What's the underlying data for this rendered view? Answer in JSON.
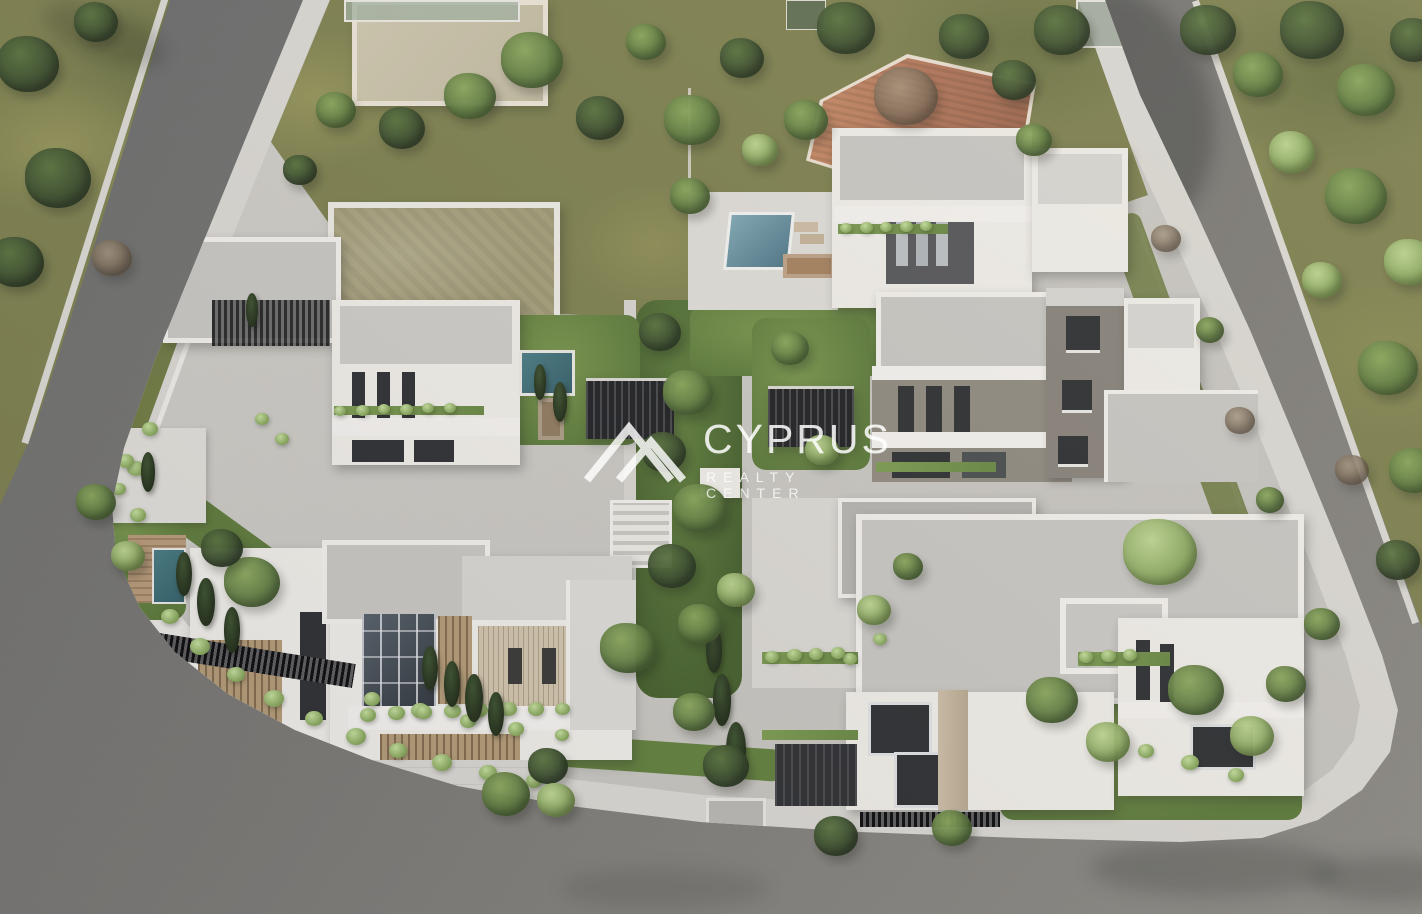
{
  "watermark": {
    "brand": "CYPRUS",
    "tagline": "REALTY CENTER",
    "logo": "mountain-peaks-icon"
  },
  "scene": {
    "setting": "Aerial 3D architectural rendering of a modern white villa development on a corner block bounded by asphalt roads, with landscaped gardens, swimming pools, pergolas and mature trees",
    "colors": {
      "asphalt": "#73726e",
      "asphalt_dark": "#585a5c",
      "sidewalk": "#dcdad5",
      "concrete": "#c9c7c2",
      "grass": "#7d8050",
      "wall_white": "#edebe6",
      "roof_gray": "#c6c5c1",
      "accent_dark": "#4e4f52",
      "taupe": "#8f8a80",
      "window": "#2f3134",
      "wood": "#a68d6e",
      "travertine": "#c3b59f",
      "terracotta_roof": "#b57a5c",
      "pool_light": "#8fc2ca",
      "pool_dark": "#41707a",
      "pergola": "#2c2d2f",
      "garden": "#66833f"
    },
    "pools": [
      {
        "id": "pool-top-villa",
        "tone": "light"
      },
      {
        "id": "pool-left-villa",
        "tone": "dark"
      },
      {
        "id": "pool-bottom-left-villa",
        "tone": "dark"
      }
    ],
    "trees": [
      {
        "x": 28,
        "y": 64,
        "s": 62,
        "t": "d"
      },
      {
        "x": 96,
        "y": 22,
        "s": 44,
        "t": "d"
      },
      {
        "x": 58,
        "y": 178,
        "s": 66,
        "t": "d"
      },
      {
        "x": 16,
        "y": 262,
        "s": 56,
        "t": "d"
      },
      {
        "x": 112,
        "y": 258,
        "s": 40,
        "t": "b"
      },
      {
        "x": 336,
        "y": 110,
        "s": 40,
        "t": "m"
      },
      {
        "x": 300,
        "y": 170,
        "s": 34,
        "t": "d"
      },
      {
        "x": 402,
        "y": 128,
        "s": 46,
        "t": "d"
      },
      {
        "x": 470,
        "y": 96,
        "s": 52,
        "t": "m"
      },
      {
        "x": 532,
        "y": 60,
        "s": 62,
        "t": "m"
      },
      {
        "x": 600,
        "y": 118,
        "s": 48,
        "t": "d"
      },
      {
        "x": 646,
        "y": 42,
        "s": 40,
        "t": "m"
      },
      {
        "x": 692,
        "y": 120,
        "s": 56,
        "t": "m"
      },
      {
        "x": 742,
        "y": 58,
        "s": 44,
        "t": "d"
      },
      {
        "x": 690,
        "y": 196,
        "s": 40,
        "t": "m"
      },
      {
        "x": 760,
        "y": 150,
        "s": 36,
        "t": "l"
      },
      {
        "x": 806,
        "y": 120,
        "s": 44,
        "t": "m"
      },
      {
        "x": 846,
        "y": 28,
        "s": 58,
        "t": "d"
      },
      {
        "x": 906,
        "y": 96,
        "s": 64,
        "t": "b"
      },
      {
        "x": 964,
        "y": 36,
        "s": 50,
        "t": "d"
      },
      {
        "x": 1014,
        "y": 80,
        "s": 44,
        "t": "d"
      },
      {
        "x": 1062,
        "y": 30,
        "s": 56,
        "t": "d"
      },
      {
        "x": 1034,
        "y": 140,
        "s": 36,
        "t": "m"
      },
      {
        "x": 1208,
        "y": 30,
        "s": 56,
        "t": "d"
      },
      {
        "x": 1258,
        "y": 74,
        "s": 50,
        "t": "m"
      },
      {
        "x": 1312,
        "y": 30,
        "s": 64,
        "t": "d"
      },
      {
        "x": 1366,
        "y": 90,
        "s": 58,
        "t": "m"
      },
      {
        "x": 1414,
        "y": 40,
        "s": 48,
        "t": "d"
      },
      {
        "x": 1292,
        "y": 152,
        "s": 46,
        "t": "l"
      },
      {
        "x": 1356,
        "y": 196,
        "s": 62,
        "t": "m"
      },
      {
        "x": 1410,
        "y": 262,
        "s": 52,
        "t": "l"
      },
      {
        "x": 1322,
        "y": 280,
        "s": 40,
        "t": "l"
      },
      {
        "x": 1388,
        "y": 368,
        "s": 60,
        "t": "m"
      },
      {
        "x": 1414,
        "y": 470,
        "s": 50,
        "t": "m"
      },
      {
        "x": 1352,
        "y": 470,
        "s": 34,
        "t": "b"
      },
      {
        "x": 1398,
        "y": 560,
        "s": 44,
        "t": "d"
      },
      {
        "x": 1166,
        "y": 238,
        "s": 30,
        "t": "b"
      },
      {
        "x": 1210,
        "y": 330,
        "s": 28,
        "t": "m"
      },
      {
        "x": 1240,
        "y": 420,
        "s": 30,
        "t": "b"
      },
      {
        "x": 1270,
        "y": 500,
        "s": 28,
        "t": "m"
      },
      {
        "x": 660,
        "y": 332,
        "s": 42,
        "t": "d"
      },
      {
        "x": 688,
        "y": 392,
        "s": 50,
        "t": "m"
      },
      {
        "x": 664,
        "y": 452,
        "s": 44,
        "t": "d"
      },
      {
        "x": 700,
        "y": 508,
        "s": 54,
        "t": "m"
      },
      {
        "x": 672,
        "y": 566,
        "s": 48,
        "t": "d"
      },
      {
        "x": 700,
        "y": 624,
        "s": 44,
        "t": "m"
      },
      {
        "x": 736,
        "y": 590,
        "s": 38,
        "t": "l"
      },
      {
        "x": 628,
        "y": 648,
        "s": 56,
        "t": "m"
      },
      {
        "x": 790,
        "y": 348,
        "s": 38,
        "t": "m"
      },
      {
        "x": 822,
        "y": 450,
        "s": 34,
        "t": "l"
      },
      {
        "x": 252,
        "y": 582,
        "s": 56,
        "t": "m"
      },
      {
        "x": 222,
        "y": 548,
        "s": 42,
        "t": "d"
      },
      {
        "x": 96,
        "y": 502,
        "s": 40,
        "t": "m"
      },
      {
        "x": 128,
        "y": 556,
        "s": 34,
        "t": "l"
      },
      {
        "x": 506,
        "y": 794,
        "s": 48,
        "t": "m"
      },
      {
        "x": 548,
        "y": 766,
        "s": 40,
        "t": "d"
      },
      {
        "x": 556,
        "y": 800,
        "s": 38,
        "t": "l"
      },
      {
        "x": 694,
        "y": 712,
        "s": 42,
        "t": "m"
      },
      {
        "x": 726,
        "y": 766,
        "s": 46,
        "t": "d"
      },
      {
        "x": 836,
        "y": 836,
        "s": 44,
        "t": "d"
      },
      {
        "x": 952,
        "y": 828,
        "s": 40,
        "t": "m"
      },
      {
        "x": 1052,
        "y": 700,
        "s": 52,
        "t": "m"
      },
      {
        "x": 1108,
        "y": 742,
        "s": 44,
        "t": "l"
      },
      {
        "x": 1160,
        "y": 552,
        "s": 74,
        "t": "l"
      },
      {
        "x": 1196,
        "y": 690,
        "s": 56,
        "t": "m"
      },
      {
        "x": 1252,
        "y": 736,
        "s": 44,
        "t": "l"
      },
      {
        "x": 1286,
        "y": 684,
        "s": 40,
        "t": "m"
      },
      {
        "x": 1322,
        "y": 624,
        "s": 36,
        "t": "m"
      },
      {
        "x": 874,
        "y": 610,
        "s": 34,
        "t": "l"
      },
      {
        "x": 908,
        "y": 566,
        "s": 30,
        "t": "m"
      }
    ],
    "bushes": [
      {
        "x": 170,
        "y": 618,
        "s": 18
      },
      {
        "x": 200,
        "y": 648,
        "s": 20
      },
      {
        "x": 236,
        "y": 676,
        "s": 18
      },
      {
        "x": 274,
        "y": 700,
        "s": 20
      },
      {
        "x": 314,
        "y": 720,
        "s": 18
      },
      {
        "x": 356,
        "y": 738,
        "s": 20
      },
      {
        "x": 398,
        "y": 752,
        "s": 18
      },
      {
        "x": 442,
        "y": 764,
        "s": 20
      },
      {
        "x": 488,
        "y": 774,
        "s": 18
      },
      {
        "x": 534,
        "y": 782,
        "s": 16
      },
      {
        "x": 372,
        "y": 700,
        "s": 16
      },
      {
        "x": 420,
        "y": 712,
        "s": 18
      },
      {
        "x": 468,
        "y": 722,
        "s": 16
      },
      {
        "x": 516,
        "y": 730,
        "s": 16
      },
      {
        "x": 562,
        "y": 736,
        "s": 14
      },
      {
        "x": 150,
        "y": 430,
        "s": 16
      },
      {
        "x": 136,
        "y": 470,
        "s": 18
      },
      {
        "x": 262,
        "y": 420,
        "s": 14
      },
      {
        "x": 282,
        "y": 440,
        "s": 14
      },
      {
        "x": 110,
        "y": 440,
        "s": 15
      },
      {
        "x": 126,
        "y": 462,
        "s": 16
      },
      {
        "x": 118,
        "y": 490,
        "s": 15
      },
      {
        "x": 138,
        "y": 516,
        "s": 16
      },
      {
        "x": 1190,
        "y": 764,
        "s": 18
      },
      {
        "x": 1236,
        "y": 776,
        "s": 16
      },
      {
        "x": 1146,
        "y": 752,
        "s": 16
      },
      {
        "x": 880,
        "y": 640,
        "s": 14
      },
      {
        "x": 850,
        "y": 660,
        "s": 14
      },
      {
        "x": 368,
        "y": 716,
        "s": 16
      },
      {
        "x": 396,
        "y": 714,
        "s": 17
      },
      {
        "x": 424,
        "y": 713,
        "s": 16
      },
      {
        "x": 452,
        "y": 712,
        "s": 17
      },
      {
        "x": 480,
        "y": 711,
        "s": 16
      },
      {
        "x": 508,
        "y": 710,
        "s": 17
      },
      {
        "x": 536,
        "y": 710,
        "s": 16
      },
      {
        "x": 562,
        "y": 710,
        "s": 15
      },
      {
        "x": 772,
        "y": 658,
        "s": 14
      },
      {
        "x": 794,
        "y": 656,
        "s": 15
      },
      {
        "x": 816,
        "y": 655,
        "s": 14
      },
      {
        "x": 838,
        "y": 654,
        "s": 14
      },
      {
        "x": 1086,
        "y": 658,
        "s": 14
      },
      {
        "x": 1108,
        "y": 657,
        "s": 15
      },
      {
        "x": 1130,
        "y": 656,
        "s": 14
      },
      {
        "x": 846,
        "y": 229,
        "s": 12
      },
      {
        "x": 866,
        "y": 228,
        "s": 13
      },
      {
        "x": 886,
        "y": 228,
        "s": 12
      },
      {
        "x": 906,
        "y": 227,
        "s": 13
      },
      {
        "x": 926,
        "y": 227,
        "s": 12
      },
      {
        "x": 340,
        "y": 412,
        "s": 12
      },
      {
        "x": 362,
        "y": 411,
        "s": 13
      },
      {
        "x": 384,
        "y": 410,
        "s": 12
      },
      {
        "x": 406,
        "y": 410,
        "s": 13
      },
      {
        "x": 428,
        "y": 409,
        "s": 12
      },
      {
        "x": 450,
        "y": 409,
        "s": 12
      }
    ],
    "cypresses": [
      {
        "x": 206,
        "y": 602,
        "s": 48
      },
      {
        "x": 184,
        "y": 574,
        "s": 44
      },
      {
        "x": 232,
        "y": 630,
        "s": 46
      },
      {
        "x": 430,
        "y": 668,
        "s": 44
      },
      {
        "x": 452,
        "y": 684,
        "s": 46
      },
      {
        "x": 474,
        "y": 698,
        "s": 48
      },
      {
        "x": 496,
        "y": 714,
        "s": 44
      },
      {
        "x": 722,
        "y": 700,
        "s": 52
      },
      {
        "x": 736,
        "y": 750,
        "s": 56
      },
      {
        "x": 714,
        "y": 650,
        "s": 46
      },
      {
        "x": 148,
        "y": 472,
        "s": 40
      },
      {
        "x": 560,
        "y": 402,
        "s": 40
      },
      {
        "x": 540,
        "y": 382,
        "s": 36
      },
      {
        "x": 252,
        "y": 310,
        "s": 34
      }
    ]
  }
}
